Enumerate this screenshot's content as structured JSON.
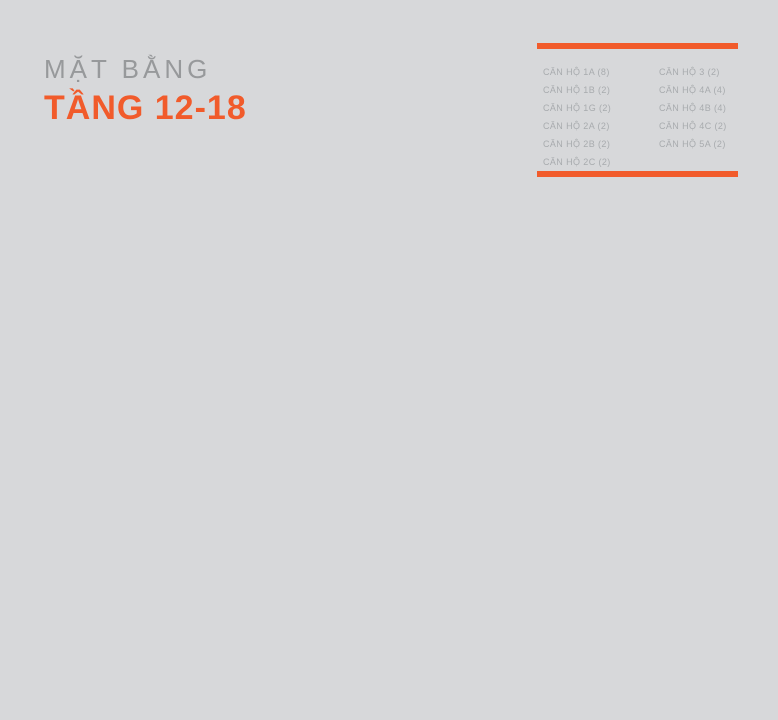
{
  "title": {
    "subtitle": "MẶT BẰNG",
    "main": "TẦNG 12-18"
  },
  "legend": {
    "col1": [
      "CĂN HỘ 1A (8)",
      "CĂN HỘ 1B (2)",
      "CĂN HỘ 1G (2)",
      "CĂN HỘ 2A (2)",
      "CĂN HỘ 2B (2)",
      "CĂN HỘ 2C (2)"
    ],
    "col2": [
      "CĂN HỘ 3 (2)",
      "CĂN HỘ 4A (4)",
      "CĂN HỘ 4B (4)",
      "CĂN HỘ 4C (2)",
      "CĂN HỘ 5A (2)"
    ]
  },
  "blocks": [
    {
      "label": "BLOCK B",
      "x": 245,
      "y": 291
    },
    {
      "label": "BLOCK A",
      "x": 532,
      "y": 291
    }
  ],
  "compass": {
    "n": "N",
    "e": "E",
    "w": "W",
    "s": "S",
    "cx": 713,
    "cy": 286
  },
  "colors": {
    "background": "#d7d8da",
    "accent_orange": "#f15b2b",
    "title_gray": "#97999b",
    "legend_text": "#a8abae",
    "plan_red": "#c4201a",
    "unit_label": "#23232d",
    "unit_light": "#f3dabb",
    "unit_mid": "#e0b98f",
    "unit_mid_dark": "#d5ad85",
    "unit_dark": "#cba17a",
    "unit_stroke": "#5a5245",
    "underlay": "#e9d3b3",
    "core_gray": "#b7b9bb",
    "road_gray": "#c3c5c7",
    "canopy_gray": "#b4b6b8",
    "pool_gray": "#bec0c2",
    "site_line": "#ffffff"
  },
  "plan": {
    "underlays": [
      [
        150,
        316,
        200,
        110
      ],
      [
        228,
        418,
        105,
        160
      ],
      [
        463,
        316,
        178,
        110
      ],
      [
        463,
        418,
        107,
        160
      ]
    ],
    "cores": [
      [
        250,
        386,
        26,
        40
      ],
      [
        277,
        426,
        8,
        108
      ],
      [
        522,
        380,
        28,
        46
      ],
      [
        513,
        426,
        8,
        108
      ]
    ],
    "units": [
      {
        "b": "B",
        "n": "9",
        "t": "2C",
        "r": [
          152,
          320,
          36,
          68
        ],
        "s": "dark",
        "np": [
          164,
          347
        ],
        "ns": 20,
        "tp": [
          170,
          374
        ],
        "notch": "top"
      },
      {
        "b": "B",
        "n": "8",
        "t": "1A",
        "r": [
          188,
          316,
          42,
          72
        ],
        "s": "light",
        "np": [
          203,
          346
        ],
        "ns": 20,
        "tp": [
          213,
          354
        ],
        "notch": "top"
      },
      {
        "b": "B",
        "n": "7",
        "t": "1A",
        "r": [
          230,
          316,
          38,
          72
        ],
        "s": "light",
        "np": [
          249,
          346
        ],
        "ns": 20,
        "tp": [
          237,
          354
        ],
        "notch": "top"
      },
      {
        "b": "B",
        "n": "6",
        "t": "1A",
        "r": [
          268,
          316,
          37,
          72
        ],
        "s": "light",
        "np": [
          287,
          346
        ],
        "ns": 20,
        "tp": [
          273,
          354
        ],
        "notch": "top"
      },
      {
        "b": "B",
        "n": "5",
        "t": "2A",
        "r": [
          305,
          320,
          41,
          68
        ],
        "s": "dark",
        "np": [
          330,
          340
        ],
        "ns": 20,
        "tp": [
          324,
          371
        ],
        "notch": "top"
      },
      {
        "b": "B",
        "n": "10",
        "t": "",
        "r": [
          150,
          388,
          42,
          38
        ],
        "s": "light",
        "np": [
          166,
          420
        ],
        "ns": 19,
        "tp": null
      },
      {
        "b": "B",
        "n": "",
        "t": "3",
        "r": [
          192,
          388,
          26,
          38
        ],
        "s": "light",
        "np": null,
        "tp": [
          204,
          401
        ]
      },
      {
        "b": "B",
        "n": "11",
        "t": "4B",
        "r": [
          218,
          388,
          32,
          38
        ],
        "s": "dark",
        "np": [
          236,
          419
        ],
        "ns": 19,
        "tp": [
          228,
          401
        ]
      },
      {
        "b": "B",
        "n": "3A",
        "t": "4C",
        "r": [
          282,
          385,
          68,
          33
        ],
        "s": "light",
        "np": [
          325,
          411
        ],
        "ns": 20,
        "tp": [
          301,
          397
        ]
      },
      {
        "b": "B",
        "n": "3",
        "t": "4A",
        "r": [
          285,
          418,
          48,
          28
        ],
        "s": "mid",
        "np": [
          318,
          432
        ],
        "ns": 17,
        "tp": [
          299,
          440
        ]
      },
      {
        "b": "B",
        "n": "2",
        "t": "4A",
        "r": [
          285,
          446,
          48,
          32
        ],
        "s": "middark",
        "np": [
          318,
          470
        ],
        "ns": 19,
        "tp": [
          299,
          462
        ]
      },
      {
        "b": "B",
        "n": "12",
        "t": "4B",
        "r": [
          232,
          428,
          45,
          42
        ],
        "s": "dark",
        "np": [
          249,
          449
        ],
        "ns": 20,
        "tp": [
          257,
          461
        ]
      },
      {
        "b": "B",
        "n": "12A",
        "t": "1B",
        "r": [
          228,
          470,
          49,
          34
        ],
        "s": "light",
        "np": [
          247,
          503
        ],
        "ns": 21,
        "tp": [
          257,
          488
        ]
      },
      {
        "b": "B",
        "n": "1",
        "t": "5A",
        "r": [
          285,
          478,
          48,
          38
        ],
        "s": "light",
        "np": [
          320,
          502
        ],
        "ns": 19,
        "tp": [
          302,
          494
        ]
      },
      {
        "b": "B",
        "n": "12B",
        "t": "1A",
        "r": [
          228,
          504,
          49,
          32
        ],
        "s": "light",
        "np": [
          248,
          533
        ],
        "ns": 21,
        "tp": [
          253,
          516
        ]
      },
      {
        "b": "B",
        "n": "15",
        "t": "2B",
        "r": [
          228,
          536,
          62,
          38
        ],
        "s": "light",
        "np": [
          240,
          570
        ],
        "ns": 20,
        "tp": [
          272,
          557
        ],
        "notch": "bottom"
      },
      {
        "b": "B",
        "n": "16",
        "t": "1G",
        "r": [
          285,
          530,
          45,
          48
        ],
        "s": "light",
        "np": [
          315,
          572
        ],
        "ns": 20,
        "tp": [
          317,
          557
        ],
        "notch": "bottom"
      },
      {
        "b": "A",
        "n": "5",
        "t": "2A",
        "r": [
          463,
          320,
          41,
          68
        ],
        "s": "dark",
        "np": [
          473,
          340
        ],
        "ns": 20,
        "tp": [
          484,
          371
        ],
        "notch": "top"
      },
      {
        "b": "A",
        "n": "6",
        "t": "1A",
        "r": [
          497,
          316,
          40,
          72
        ],
        "s": "light",
        "np": [
          512,
          346
        ],
        "ns": 20,
        "tp": [
          528,
          354
        ],
        "notch": "top"
      },
      {
        "b": "A",
        "n": "7",
        "t": "1A",
        "r": [
          537,
          316,
          38,
          72
        ],
        "s": "light",
        "np": [
          549,
          346
        ],
        "ns": 20,
        "tp": [
          566,
          354
        ],
        "notch": "top"
      },
      {
        "b": "A",
        "n": "8",
        "t": "1A",
        "r": [
          575,
          316,
          38,
          72
        ],
        "s": "light",
        "np": [
          597,
          346
        ],
        "ns": 20,
        "tp": [
          584,
          354
        ],
        "notch": "top"
      },
      {
        "b": "A",
        "n": "9",
        "t": "2C",
        "r": [
          613,
          320,
          28,
          68
        ],
        "s": "dark",
        "np": [
          630,
          347
        ],
        "ns": 20,
        "tp": [
          626,
          374
        ],
        "notch": "top"
      },
      {
        "b": "A",
        "n": "3A",
        "t": "4C",
        "r": [
          463,
          385,
          68,
          33
        ],
        "s": "light",
        "np": [
          478,
          411
        ],
        "ns": 20,
        "tp": [
          500,
          397
        ]
      },
      {
        "b": "A",
        "n": "11",
        "t": "4B",
        "r": [
          550,
          388,
          36,
          38
        ],
        "s": "dark",
        "np": [
          566,
          420
        ],
        "ns": 19,
        "tp": [
          580,
          401
        ]
      },
      {
        "b": "A",
        "n": "",
        "t": "3",
        "r": [
          586,
          388,
          26,
          38
        ],
        "s": "light",
        "np": null,
        "tp": [
          599,
          401
        ]
      },
      {
        "b": "A",
        "n": "10",
        "t": "",
        "r": [
          612,
          388,
          29,
          38
        ],
        "s": "light",
        "np": [
          627,
          419
        ],
        "ns": 19,
        "tp": null
      },
      {
        "b": "A",
        "n": "3",
        "t": "4A",
        "r": [
          463,
          418,
          50,
          28
        ],
        "s": "mid",
        "np": [
          480,
          432
        ],
        "ns": 17,
        "tp": [
          500,
          440
        ]
      },
      {
        "b": "A",
        "n": "2",
        "t": "4A",
        "r": [
          463,
          446,
          50,
          32
        ],
        "s": "middark",
        "np": [
          480,
          470
        ],
        "ns": 19,
        "tp": [
          500,
          462
        ]
      },
      {
        "b": "A",
        "n": "12",
        "t": "4B",
        "r": [
          520,
          428,
          46,
          42
        ],
        "s": "dark",
        "np": [
          551,
          448
        ],
        "ns": 20,
        "tp": [
          540,
          461
        ]
      },
      {
        "b": "A",
        "n": "1",
        "t": "5A",
        "r": [
          463,
          478,
          50,
          38
        ],
        "s": "light",
        "np": [
          480,
          502
        ],
        "ns": 19,
        "tp": [
          499,
          494
        ]
      },
      {
        "b": "A",
        "n": "12A",
        "t": "1B",
        "r": [
          520,
          470,
          50,
          34
        ],
        "s": "light",
        "np": [
          554,
          503
        ],
        "ns": 21,
        "tp": [
          540,
          488
        ]
      },
      {
        "b": "A",
        "n": "12B",
        "t": "1A",
        "r": [
          520,
          504,
          50,
          32
        ],
        "s": "light",
        "np": [
          553,
          533
        ],
        "ns": 21,
        "tp": [
          540,
          516
        ]
      },
      {
        "b": "A",
        "n": "16",
        "t": "1G",
        "r": [
          463,
          530,
          50,
          48
        ],
        "s": "light",
        "np": [
          485,
          572
        ],
        "ns": 20,
        "tp": [
          481,
          557
        ],
        "notch": "bottom"
      },
      {
        "b": "A",
        "n": "15",
        "t": "2B",
        "r": [
          513,
          536,
          57,
          38
        ],
        "s": "light",
        "np": [
          556,
          570
        ],
        "ns": 20,
        "tp": [
          524,
          557
        ],
        "notch": "bottom"
      }
    ]
  }
}
